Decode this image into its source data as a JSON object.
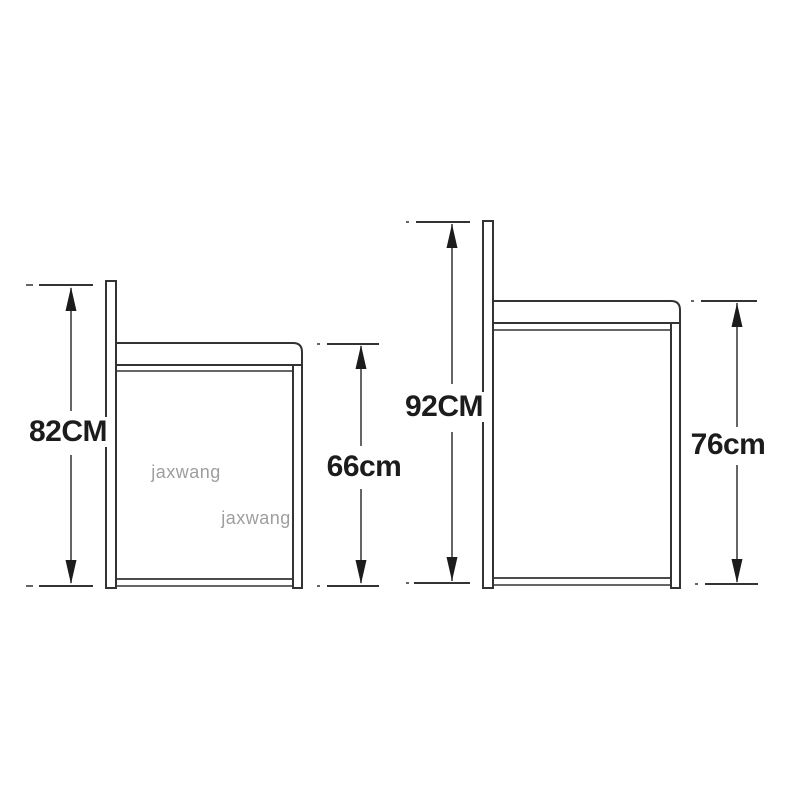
{
  "diagram": {
    "type": "product-dimension-diagram",
    "subject": "two bar stools side view with height dimensions",
    "left_stool": {
      "overall_height": {
        "label": "82CM",
        "value_cm": 82
      },
      "seat_height": {
        "label": "66cm",
        "value_cm": 66
      }
    },
    "right_stool": {
      "overall_height": {
        "label": "92CM",
        "value_cm": 92
      },
      "seat_height": {
        "label": "76cm",
        "value_cm": 76
      }
    },
    "watermark_text": "jaxwang",
    "colors": {
      "background": "#ffffff",
      "line": "#333333",
      "label_text": "#1c1c1c",
      "watermark": "#9e9e9e"
    }
  }
}
